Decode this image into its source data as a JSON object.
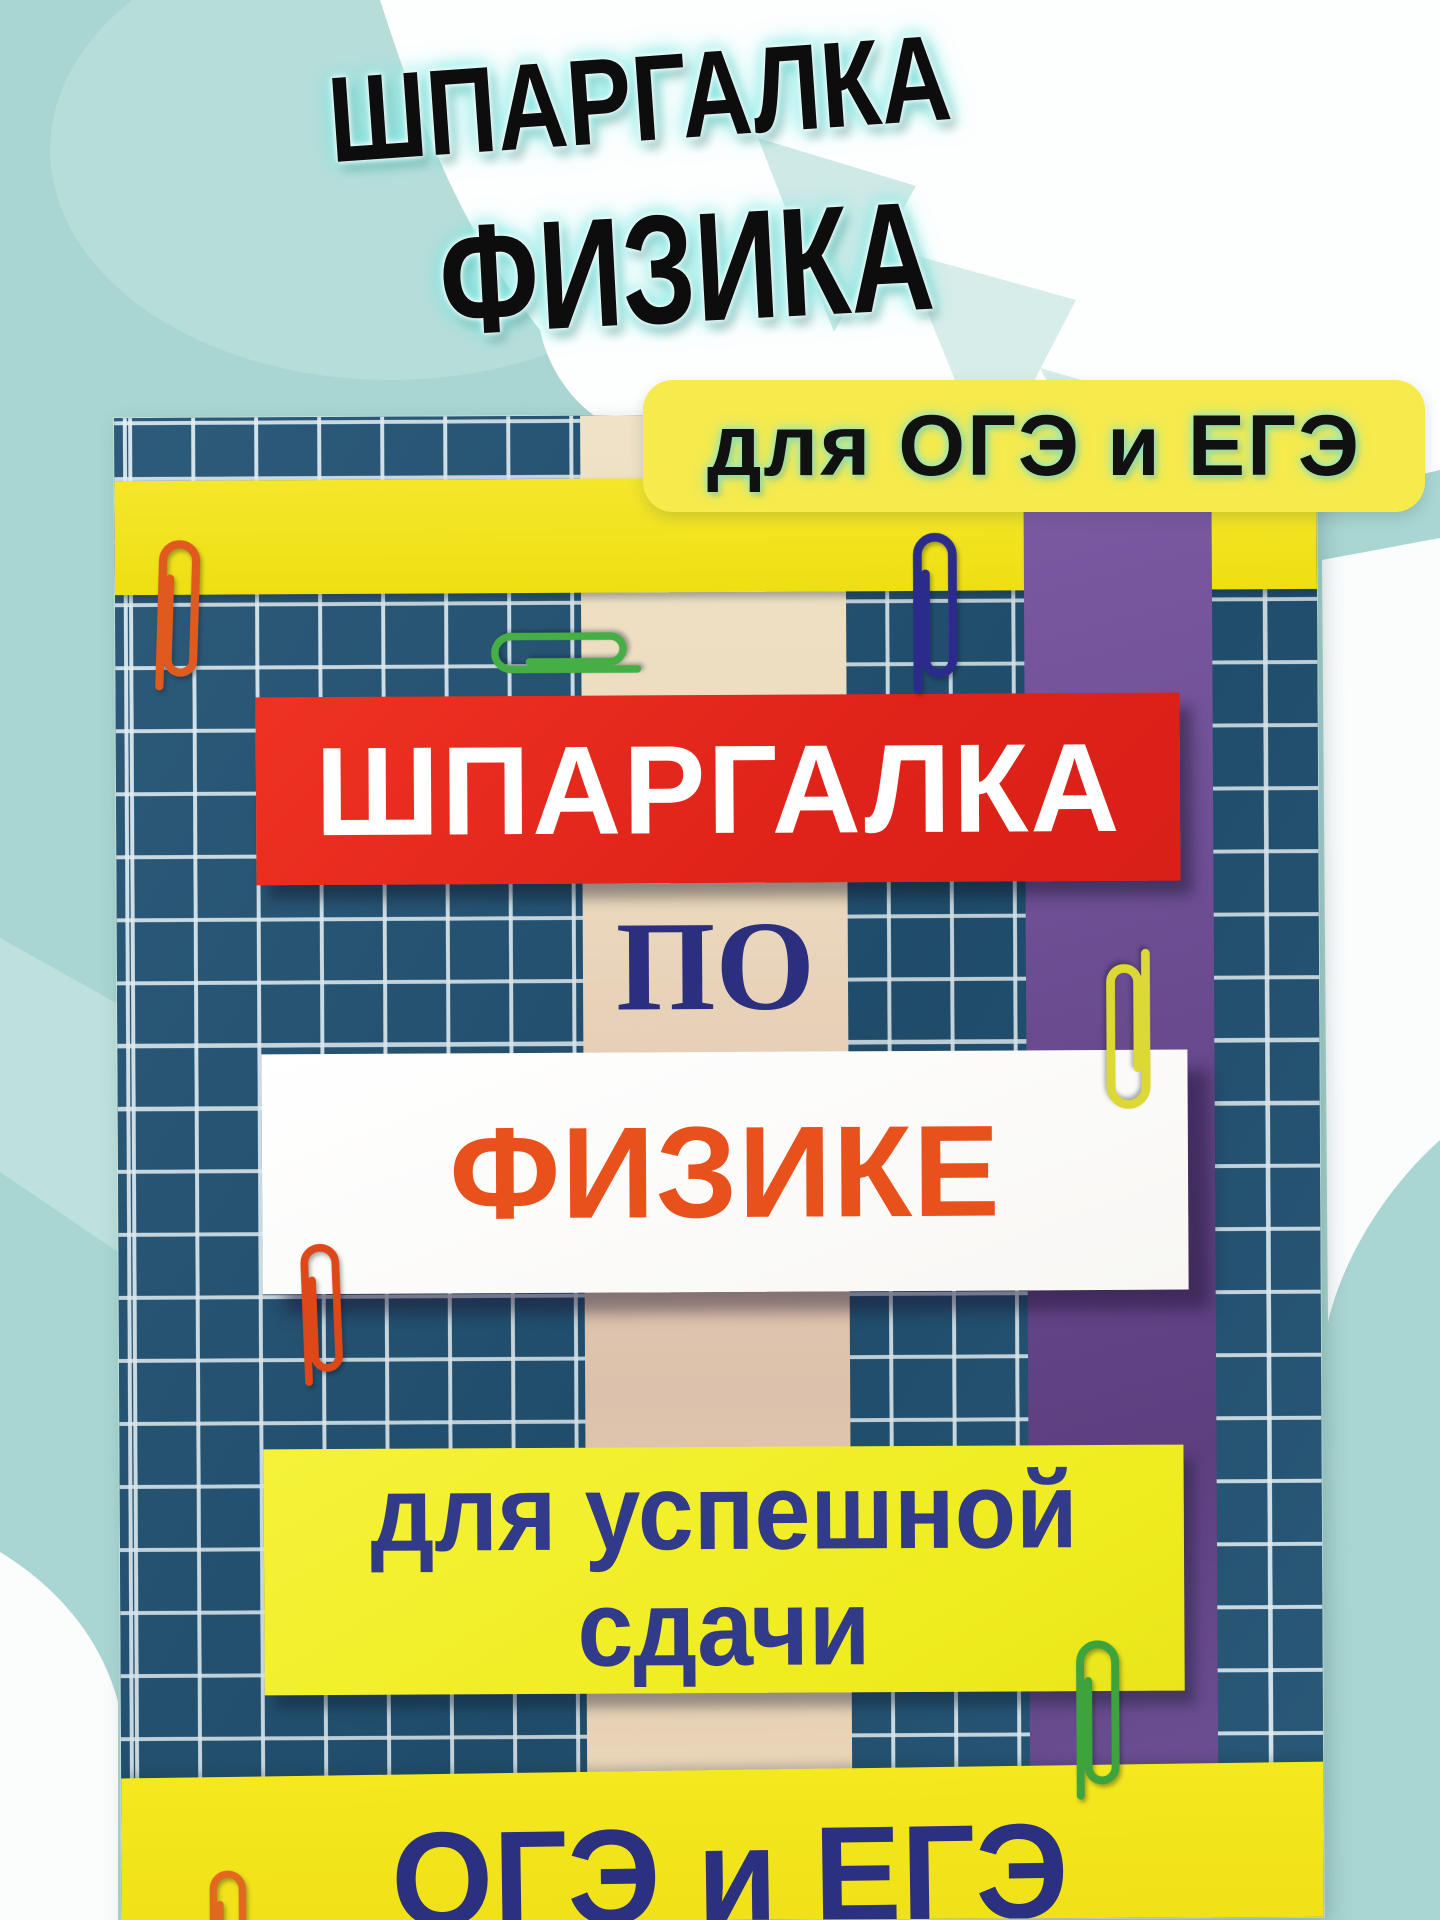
{
  "title": {
    "line1": "ШПАРГАЛКА",
    "line2": "ФИЗИКА",
    "text_color": "#0d0d0d",
    "glow_colors": [
      "#ffffff",
      "#7de9e3"
    ]
  },
  "badge": {
    "label": "для ОГЭ и ЕГЭ",
    "bg_color": "#f6ea4d",
    "text_color": "#111111"
  },
  "background": {
    "base_color": "#a9d6d2",
    "shape_colors": [
      "#ffffff",
      "#bcdfdb",
      "#cfe9e6"
    ]
  },
  "cover": {
    "red_banner": "ШПАРГАЛКА",
    "po": "ПО",
    "subject": "ФИЗИКЕ",
    "slogan_line1": "для успешной",
    "slogan_line2": "сдачи",
    "exams": "ОГЭ и ЕГЭ",
    "colors": {
      "grid_bg": "#225273",
      "grid_line": "#e2eff5",
      "yellow_stripe": "#f2e41f",
      "purple_band": "#6a4b90",
      "cream_band": "#ecdcc0",
      "red_banner_bg": "#e0231a",
      "red_banner_text": "#ffffff",
      "subject_text": "#e8501c",
      "white_card_bg": "#ffffff",
      "slogan_bg": "#efec1f",
      "slogan_text": "#323a8a",
      "bottom_band_bg": "#f4e81e",
      "exams_text": "#2b317e",
      "po_text": "#2b2f7e"
    },
    "paperclips": [
      {
        "name": "orange-paperclip-top-left",
        "color": "#e05a1f"
      },
      {
        "name": "green-paperclip-horizontal",
        "color": "#45ae45"
      },
      {
        "name": "navy-paperclip-top",
        "color": "#2b2b8c"
      },
      {
        "name": "yellow-paperclip-right",
        "color": "#dcd835"
      },
      {
        "name": "red-paperclip-left",
        "color": "#de4718"
      },
      {
        "name": "green-paperclip-bottom-right",
        "color": "#3da43d"
      },
      {
        "name": "orange-paperclip-bottom-left",
        "color": "#e2671f"
      }
    ]
  }
}
